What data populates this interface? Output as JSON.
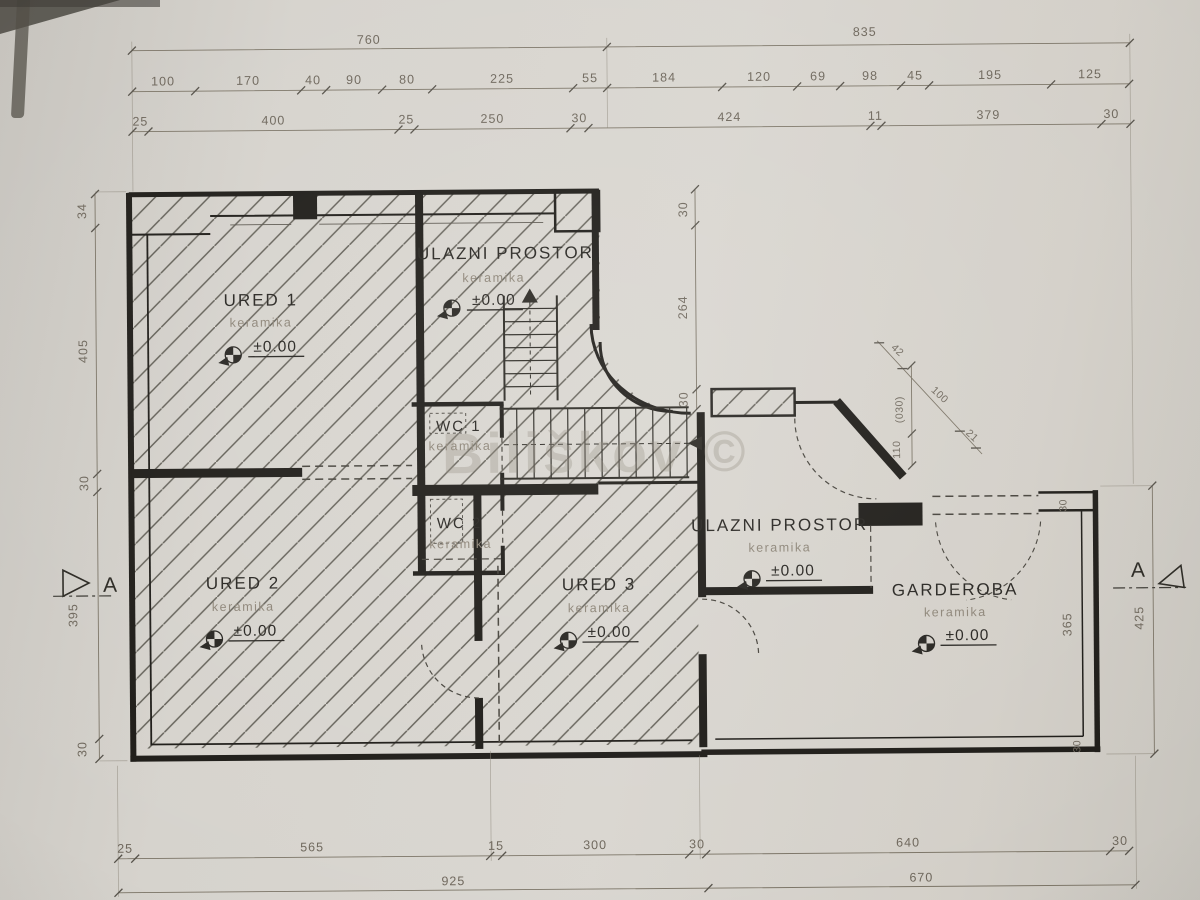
{
  "watermark": "Biliškov ©",
  "section": {
    "label": "A"
  },
  "colors": {
    "ink": "#262420",
    "dim_text": "#6e675c",
    "paper": "#d6d3cd",
    "watermark": "#8f887b"
  },
  "rooms": {
    "ured1": {
      "name": "URED 1",
      "material": "keramika",
      "level": "±0.00"
    },
    "ulazni_top": {
      "name": "ULAZNI PROSTOR",
      "material": "keramika",
      "level": "±0.00"
    },
    "wc1": {
      "name": "WC 1",
      "material": "keramika"
    },
    "wc2": {
      "name": "WC 2",
      "material": "keramika"
    },
    "ured2": {
      "name": "URED 2",
      "material": "keramika",
      "level": "±0.00"
    },
    "ured3": {
      "name": "URED 3",
      "material": "keramika",
      "level": "±0.00"
    },
    "ulazni_right": {
      "name": "ULAZNI PROSTOR",
      "material": "keramika",
      "level": "±0.00"
    },
    "garderoba": {
      "name": "GARDEROBA",
      "material": "keramika",
      "level": "±0.00"
    }
  },
  "dims": {
    "top1": [
      "760",
      "835"
    ],
    "top2": [
      "100",
      "170",
      "40",
      "90",
      "80",
      "225",
      "55",
      "184",
      "120",
      "69",
      "98",
      "45",
      "195",
      "125"
    ],
    "top3": [
      "25",
      "400",
      "25",
      "250",
      "30",
      "424",
      "11",
      "379",
      "30"
    ],
    "left": [
      "34",
      "405",
      "30",
      "395",
      "30"
    ],
    "mid": [
      "30",
      "264",
      "30"
    ],
    "diag": [
      "42",
      "100",
      "21"
    ],
    "diag_v": [
      "(030)",
      "110"
    ],
    "right": [
      "425"
    ],
    "right_inner": [
      "30",
      "365",
      "30"
    ],
    "bottom1": [
      "25",
      "565",
      "15",
      "300",
      "30",
      "640",
      "30"
    ],
    "bottom2": [
      "925",
      "670"
    ]
  }
}
